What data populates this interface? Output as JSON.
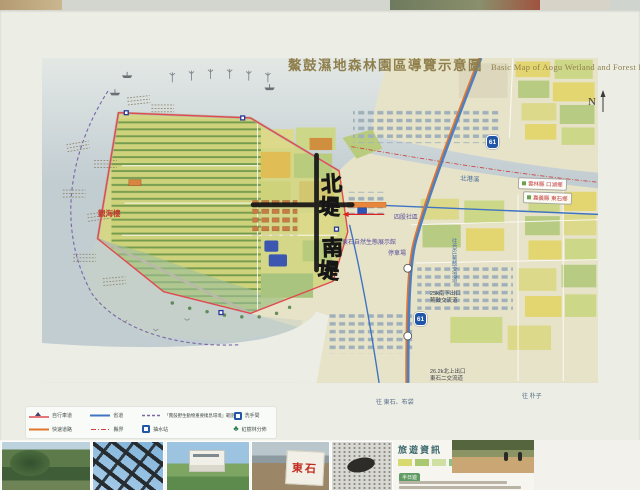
{
  "poster": {
    "title_zh": "鰲鼓濕地森林園區導覽示意圖",
    "title_en": "Basic Map of Aogu Wetland and Forest Park",
    "compass_n": "N"
  },
  "map": {
    "handwritten": {
      "char1": "北",
      "char2": "堤",
      "char3": "南",
      "char4": "堤"
    },
    "river_name": "北港溪",
    "county_labels": {
      "north": "雲林縣 口湖鄉",
      "south": "嘉義縣 東石鄉"
    },
    "highway_shield": "61",
    "interchanges": {
      "aogu": {
        "line1": "25k南下出口",
        "line2": "鰲鼓交流道"
      },
      "dongshi2": {
        "line1": "26.2k北上出口",
        "line2": "東石二交流道"
      }
    },
    "directions": {
      "south": "往 東石、布袋",
      "east": "往 朴子"
    },
    "landmarks": {
      "guanhailou": "觀海樓",
      "exhibit_hall": "東石自然生態展示館",
      "parking": "停車場",
      "sigu_village": "四股社區",
      "to_highway": "往台61鰲鼓交流道"
    }
  },
  "legend": {
    "items": [
      {
        "name": "bike-route",
        "label": "自行車道"
      },
      {
        "name": "provincial-road",
        "label": "省道"
      },
      {
        "name": "habitat-boundary",
        "label": "「鰲鼓野生動物重要棲息環境」範圍"
      },
      {
        "name": "restroom",
        "label": "洗手間"
      },
      {
        "name": "expressway",
        "label": "快速道路"
      },
      {
        "name": "county-border",
        "label": "縣界"
      },
      {
        "name": "pump-station",
        "label": "抽水站"
      },
      {
        "name": "mangrove",
        "label": "紅樹林分佈"
      }
    ]
  },
  "info_panel": {
    "title": "旅遊資訊",
    "badge": "半日遊"
  },
  "photos": {
    "dongshi_sign": "東石"
  },
  "colors": {
    "route_red": "#e04a50",
    "expressway_orange": "#e2762d",
    "provincial_blue": "#3f74c2"
  }
}
